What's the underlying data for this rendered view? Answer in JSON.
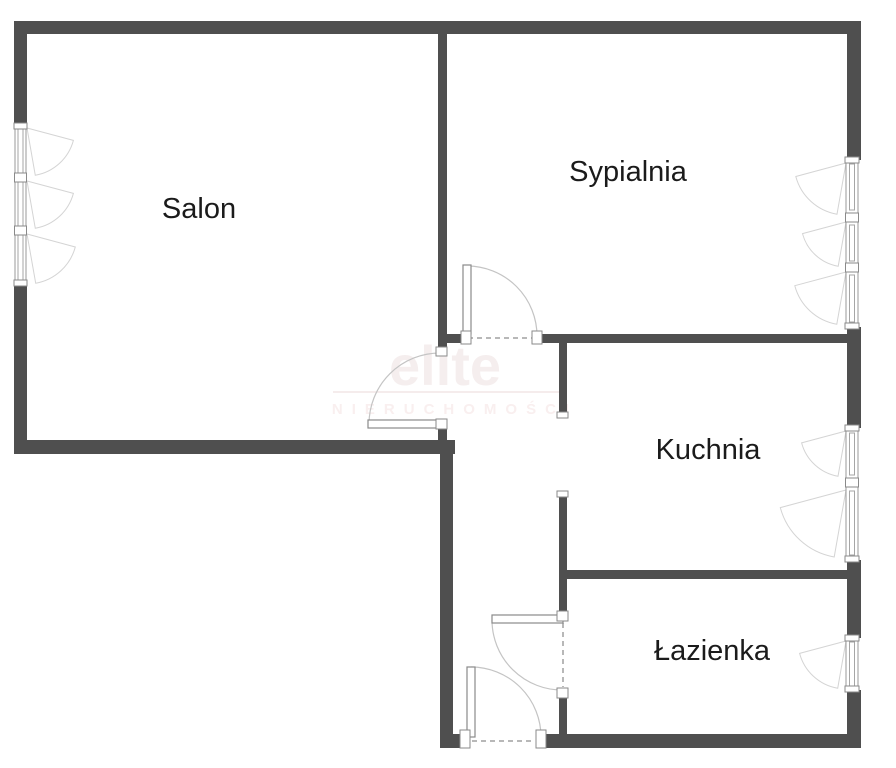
{
  "title": "Floor plan",
  "colors": {
    "wall": "#4f4f4f",
    "label": "#1b1b1b",
    "watermark_big": "#f5eeee",
    "watermark_small": "#f9efef",
    "watermark_line": "#f2e6e6"
  },
  "rooms": [
    {
      "name": "Salon"
    },
    {
      "name": "Sypialnia"
    },
    {
      "name": "Kuchnia"
    },
    {
      "name": "Łazienka"
    }
  ],
  "watermark": {
    "line1": "elite",
    "line2": "NIERUCHOMOŚCI"
  },
  "symbols": {
    "windows": [
      "salon-window-left-wall",
      "sypialnia-window-right-wall",
      "kuchnia-window-right-wall",
      "lazienka-window-right-wall"
    ],
    "doors": [
      "salon-door",
      "sypialnia-door",
      "lazienka-door",
      "entrance-door"
    ],
    "openings": [
      "kuchnia-opening"
    ]
  }
}
